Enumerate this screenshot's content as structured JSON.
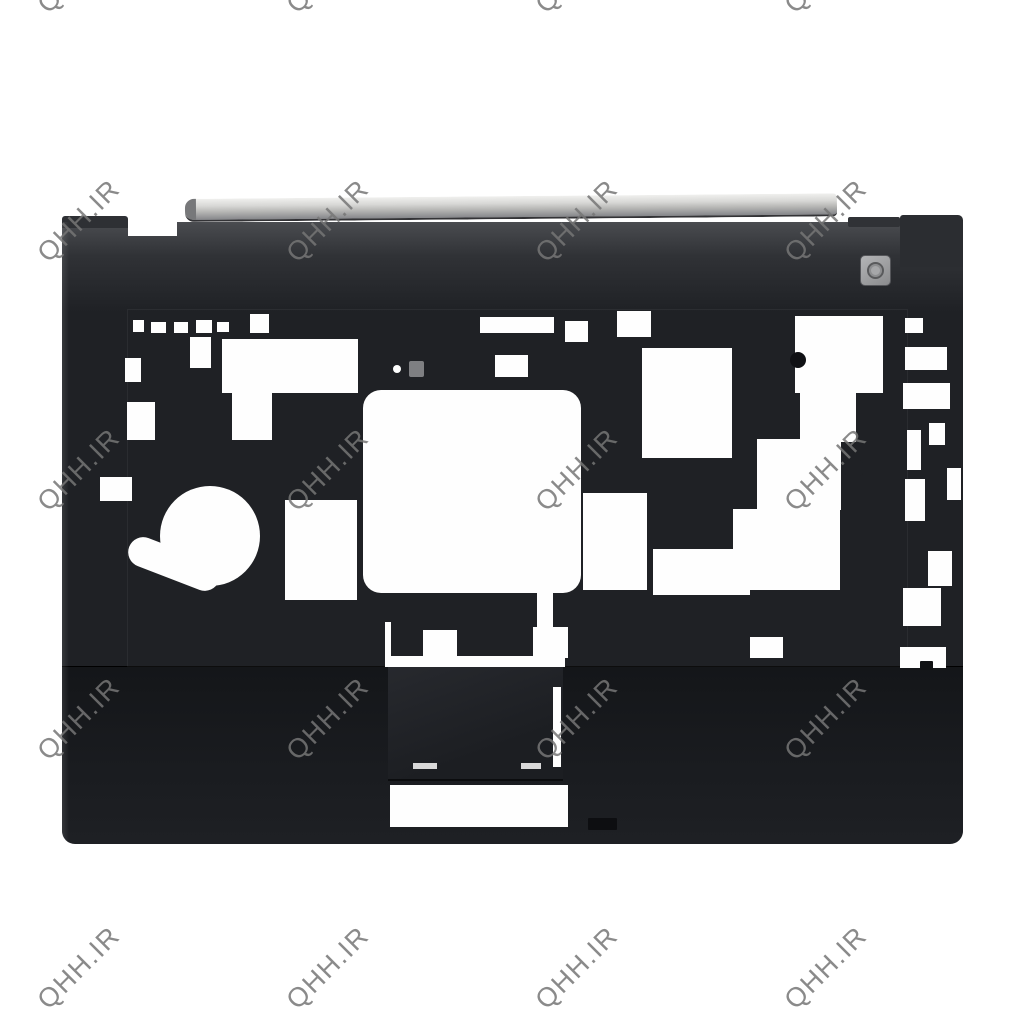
{
  "scene": {
    "width": 1024,
    "height": 1024,
    "background_color": "#ffffff",
    "subject": "laptop palmrest top cover (product photo, black plastic, no keyboard installed)"
  },
  "watermark": {
    "text": "QHH.IR",
    "color": "rgba(118,118,118,0.85)",
    "font_size_px": 27,
    "rotation_deg": -45,
    "columns_x": [
      79,
      328,
      577,
      826,
      1075
    ],
    "rows_y": [
      -28,
      221,
      470,
      719,
      968
    ]
  },
  "palmrest": {
    "body_color": "#1f2125",
    "hinge_strip_color": "#d7d7d5",
    "power_button_color": "#9fa0a2",
    "touchpad_color": "#25272c",
    "cutout_color": "#fefefe"
  },
  "shapes": {
    "white_cutouts": [
      {
        "x": 133,
        "y": 320,
        "w": 11,
        "h": 12
      },
      {
        "x": 151,
        "y": 322,
        "w": 15,
        "h": 11
      },
      {
        "x": 174,
        "y": 322,
        "w": 14,
        "h": 11
      },
      {
        "x": 196,
        "y": 320,
        "w": 16,
        "h": 13
      },
      {
        "x": 217,
        "y": 322,
        "w": 12,
        "h": 10
      },
      {
        "x": 250,
        "y": 314,
        "w": 19,
        "h": 19
      },
      {
        "x": 480,
        "y": 317,
        "w": 74,
        "h": 16
      },
      {
        "x": 495,
        "y": 355,
        "w": 33,
        "h": 22
      },
      {
        "x": 565,
        "y": 321,
        "w": 23,
        "h": 21
      },
      {
        "x": 617,
        "y": 311,
        "w": 34,
        "h": 26
      },
      {
        "x": 190,
        "y": 337,
        "w": 21,
        "h": 31
      },
      {
        "x": 125,
        "y": 358,
        "w": 16,
        "h": 24
      },
      {
        "x": 127,
        "y": 402,
        "w": 28,
        "h": 38
      },
      {
        "x": 222,
        "y": 339,
        "w": 136,
        "h": 54
      },
      {
        "x": 232,
        "y": 393,
        "w": 40,
        "h": 47
      },
      {
        "x": 363,
        "y": 390,
        "w": 218,
        "h": 203,
        "r": 18
      },
      {
        "x": 537,
        "y": 592,
        "w": 16,
        "h": 38
      },
      {
        "x": 583,
        "y": 493,
        "w": 64,
        "h": 97
      },
      {
        "x": 642,
        "y": 348,
        "w": 90,
        "h": 110
      },
      {
        "x": 653,
        "y": 549,
        "w": 97,
        "h": 46
      },
      {
        "x": 733,
        "y": 509,
        "w": 107,
        "h": 81
      },
      {
        "x": 757,
        "y": 439,
        "w": 84,
        "h": 71
      },
      {
        "x": 800,
        "y": 390,
        "w": 56,
        "h": 52
      },
      {
        "x": 795,
        "y": 316,
        "w": 88,
        "h": 77
      },
      {
        "x": 905,
        "y": 318,
        "w": 18,
        "h": 15
      },
      {
        "x": 905,
        "y": 347,
        "w": 42,
        "h": 23
      },
      {
        "x": 903,
        "y": 383,
        "w": 47,
        "h": 26
      },
      {
        "x": 907,
        "y": 430,
        "w": 14,
        "h": 40
      },
      {
        "x": 929,
        "y": 423,
        "w": 16,
        "h": 22
      },
      {
        "x": 905,
        "y": 479,
        "w": 20,
        "h": 42
      },
      {
        "x": 947,
        "y": 468,
        "w": 14,
        "h": 32
      },
      {
        "x": 928,
        "y": 551,
        "w": 24,
        "h": 35
      },
      {
        "x": 903,
        "y": 588,
        "w": 38,
        "h": 38
      },
      {
        "x": 423,
        "y": 630,
        "w": 34,
        "h": 32
      },
      {
        "x": 533,
        "y": 627,
        "w": 35,
        "h": 31
      },
      {
        "x": 385,
        "y": 622,
        "w": 6,
        "h": 45
      },
      {
        "x": 388,
        "y": 656,
        "w": 177,
        "h": 11
      },
      {
        "x": 750,
        "y": 637,
        "w": 33,
        "h": 21
      },
      {
        "x": 900,
        "y": 647,
        "w": 46,
        "h": 21
      },
      {
        "x": 285,
        "y": 500,
        "w": 72,
        "h": 100
      },
      {
        "x": 100,
        "y": 477,
        "w": 32,
        "h": 24
      },
      {
        "x": 160,
        "y": 486,
        "w": 100,
        "h": 100,
        "r": 50
      },
      {
        "x": 126,
        "y": 549,
        "w": 96,
        "h": 30,
        "r": 15,
        "rot": 21
      },
      {
        "x": 390,
        "y": 785,
        "w": 178,
        "h": 42
      },
      {
        "x": 553,
        "y": 687,
        "w": 8,
        "h": 80
      },
      {
        "x": 393,
        "y": 365,
        "w": 8,
        "h": 8,
        "r": 4
      },
      {
        "x": 413,
        "y": 763,
        "w": 24,
        "h": 6,
        "c": "#d9d9d9"
      },
      {
        "x": 521,
        "y": 763,
        "w": 20,
        "h": 6,
        "c": "#d9d9d9"
      }
    ],
    "details": [
      {
        "x": 790,
        "y": 352,
        "w": 16,
        "h": 16,
        "r": 8,
        "c": "#101114"
      },
      {
        "x": 409,
        "y": 361,
        "w": 15,
        "h": 16,
        "r": 2,
        "c": "#7e7f82"
      },
      {
        "x": 920,
        "y": 661,
        "w": 13,
        "h": 9,
        "r": 1,
        "c": "#101114"
      },
      {
        "x": 588,
        "y": 818,
        "w": 29,
        "h": 12,
        "r": 1,
        "c": "#0d0e11"
      },
      {
        "x": 845,
        "y": 460,
        "w": 18,
        "h": 16,
        "r": 3,
        "c": "#1f2125"
      }
    ]
  }
}
